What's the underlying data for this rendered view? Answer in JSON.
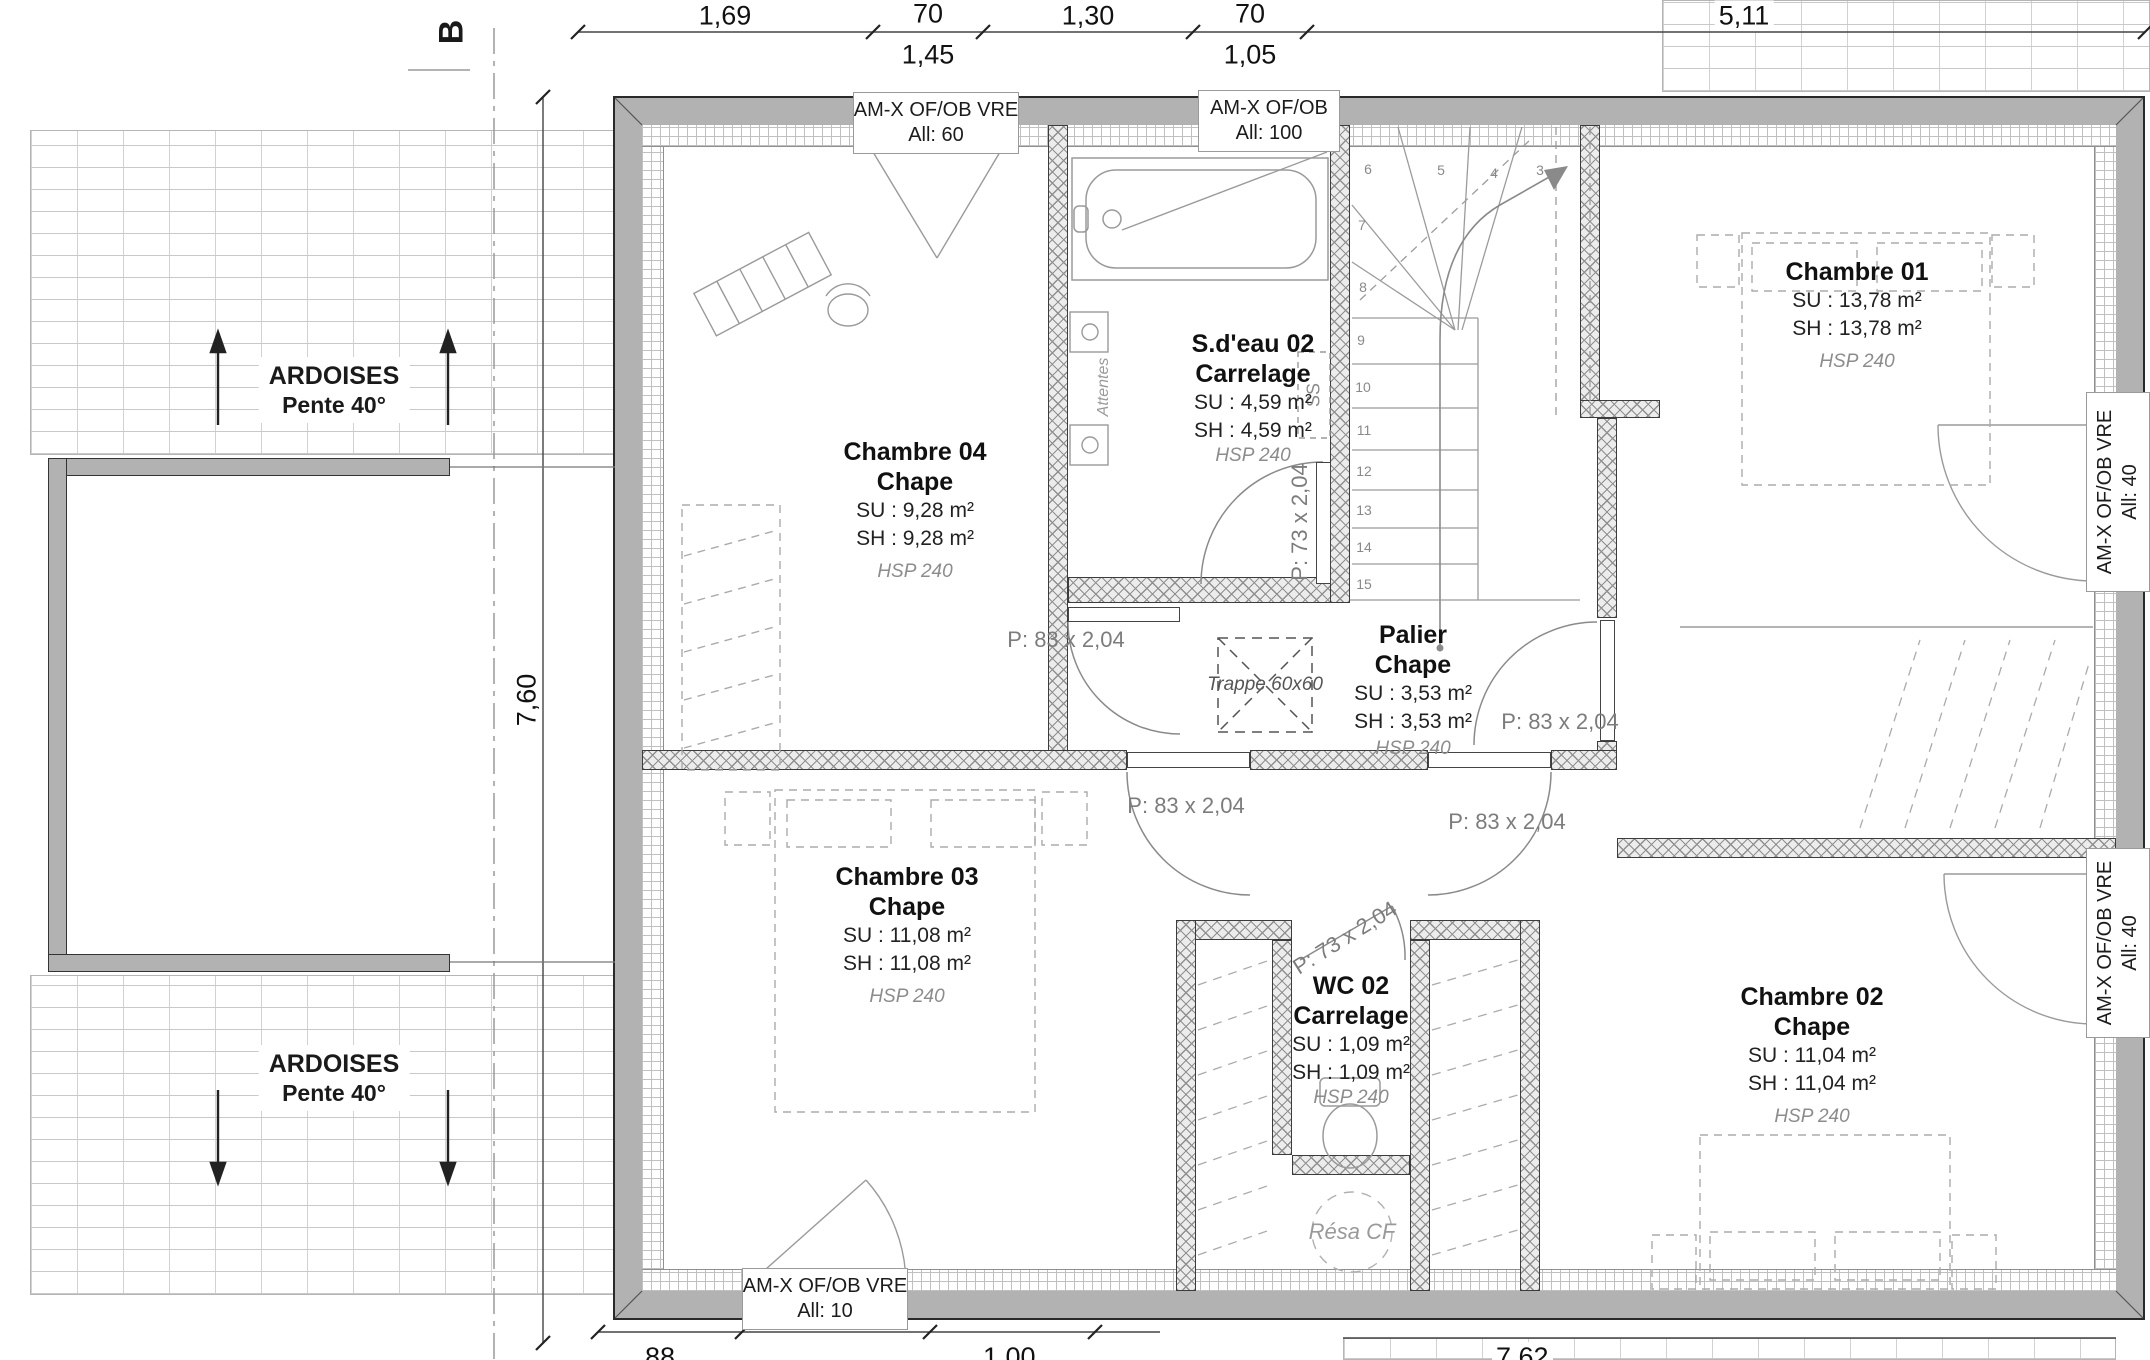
{
  "plan": {
    "rooms": [
      {
        "name": "Chambre 04",
        "finish": "Chape",
        "su": "SU : 9,28 m²",
        "sh": "SH : 9,28 m²",
        "hsp": "HSP 240"
      },
      {
        "name": "S.d'eau 02",
        "finish": "Carrelage",
        "su": "SU : 4,59 m²",
        "sh": "SH : 4,59 m²",
        "hsp": "HSP 240"
      },
      {
        "name": "Chambre 01",
        "finish": "Chape",
        "su": "SU : 13,78 m²",
        "sh": "SH : 13,78 m²",
        "hsp": "HSP 240"
      },
      {
        "name": "Palier",
        "finish": "Chape",
        "su": "SU : 3,53 m²",
        "sh": "SH : 3,53 m²",
        "hsp": "HSP 240"
      },
      {
        "name": "Chambre 03",
        "finish": "Chape",
        "su": "SU : 11,08 m²",
        "sh": "SH : 11,08 m²",
        "hsp": "HSP 240"
      },
      {
        "name": "WC 02",
        "finish": "Carrelage",
        "su": "SU : 1,09 m²",
        "sh": "SH : 1,09 m²",
        "hsp": "HSP 240"
      },
      {
        "name": "Chambre 02",
        "finish": "Chape",
        "su": "SU : 11,04 m²",
        "sh": "SH : 11,04 m²",
        "hsp": "HSP 240"
      }
    ],
    "openings": [
      {
        "l1": "AM-X OF/OB VRE",
        "l2": "All:  60"
      },
      {
        "l1": "AM-X OF/OB",
        "l2": "All:  100"
      },
      {
        "l1": "AM-X OF/OB VRE",
        "l2": "All:  40"
      },
      {
        "l1": "AM-X OF/OB VRE",
        "l2": "All:  40"
      },
      {
        "l1": "AM-X OF/OB VRE",
        "l2": "All:  10"
      }
    ],
    "doors": {
      "p83": "P: 83 x 2,04",
      "p73": "P: 73 x 2,04"
    },
    "stairs": {
      "numbers": [
        "3",
        "4",
        "5",
        "6",
        "7",
        "8",
        "9",
        "10",
        "11",
        "12",
        "13",
        "14",
        "15"
      ],
      "label": "SS"
    },
    "notes": {
      "trappe": "Trappe 60x60",
      "resa": "Résa CF",
      "attentes": "Attentes"
    }
  },
  "dimensions": {
    "top": [
      "1,69",
      "70",
      "1,30",
      "70"
    ],
    "top_sub": [
      "1,45",
      "1,05"
    ],
    "top_right": "5,11",
    "left": "7,60",
    "bottom": [
      "88",
      "1,00"
    ],
    "bottom_right": "7,62",
    "section": "B"
  },
  "roof": {
    "label_line1": "ARDOISES",
    "label_line2": "Pente 40°"
  }
}
